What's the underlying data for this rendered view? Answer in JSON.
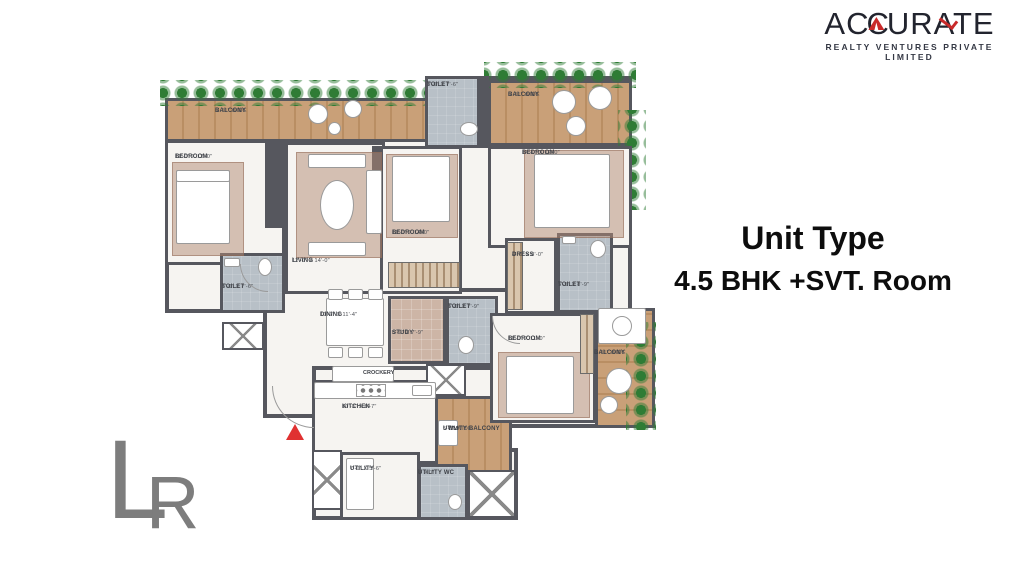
{
  "brand": {
    "name_part1": "A",
    "name_part2": "CC",
    "name_part3": "URATE",
    "tagline": "REALTY VENTURES PRIVATE LIMITED",
    "accent_color": "#c92a2a"
  },
  "title": {
    "line1": "Unit Type",
    "line2": "4.5 BHK +SVT. Room"
  },
  "watermark": {
    "letter1": "L",
    "letter2": "R"
  },
  "plan": {
    "colors": {
      "wall": "#56575e",
      "floor": "#f6f4f1",
      "toilet_floor": "#b8c0c7",
      "balcony_wood": "#c9a078",
      "plants": "#2f7c35",
      "entry_marker": "#e03131"
    },
    "rooms": [
      {
        "name": "BALCONY",
        "dims": "5'-11\" WIDE"
      },
      {
        "name": "BEDROOM",
        "dims": "11'-0\" x 12'-0\""
      },
      {
        "name": "TOILET",
        "dims": "5'-0\" x 7'-6\""
      },
      {
        "name": "LIVING",
        "dims": "12'-0\" x 14'-0\""
      },
      {
        "name": "BEDROOM",
        "dims": "11'-0\" x 14'-0\""
      },
      {
        "name": "TOILET",
        "dims": "3'-6\" x 7'-6\""
      },
      {
        "name": "BALCONY",
        "dims": "5'-11\" WIDE"
      },
      {
        "name": "BEDROOM",
        "dims": "14'-0\" x 12'-0\""
      },
      {
        "name": "DRESS",
        "dims": "4'-7\" x 8'-0\""
      },
      {
        "name": "TOILET",
        "dims": "5'-5\" x 8'-9\""
      },
      {
        "name": "DINING",
        "dims": "10'-7\" x 11'-4\""
      },
      {
        "name": "STUDY",
        "dims": "5'-9\" x 7'-9\""
      },
      {
        "name": "TOILET",
        "dims": "5'-0\" x 7'-9\""
      },
      {
        "name": "BEDROOM",
        "dims": "11'-0\" x 11'-0\""
      },
      {
        "name": "BALCONY",
        "dims": "5'-11\" WIDE"
      },
      {
        "name": "CROCKERY",
        "dims": ""
      },
      {
        "name": "KITCHEN",
        "dims": "10'-3\" x 8'-7\""
      },
      {
        "name": "UTILITY BALCONY",
        "dims": "5'-1\" WIDE"
      },
      {
        "name": "UTILITY",
        "dims": "7'-0\" x 5'-6\""
      },
      {
        "name": "UTILITY WC",
        "dims": "5' x 7'"
      },
      {
        "name": "WM",
        "dims": ""
      }
    ]
  }
}
